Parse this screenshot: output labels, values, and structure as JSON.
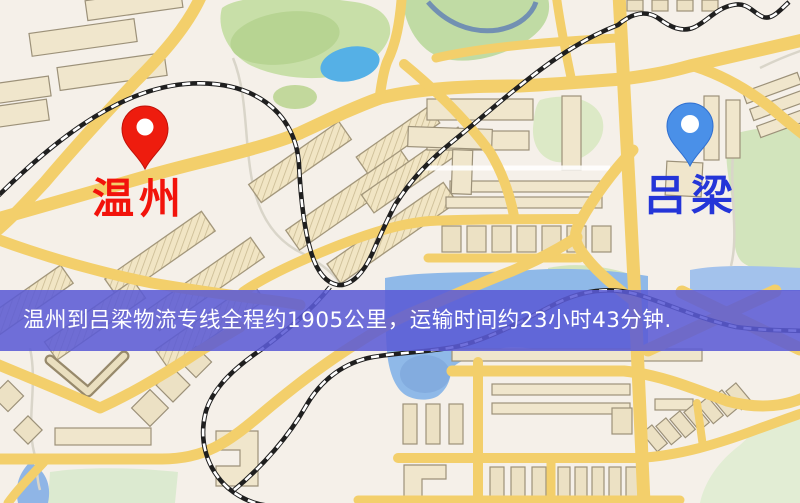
{
  "banner": {
    "text": "温州到吕梁物流专线全程约1905公里，运输时间约23小时43分钟.",
    "background": "#5b5bd6",
    "text_color": "#ffffff"
  },
  "markers": {
    "origin": {
      "label": "温州",
      "pin": "red-location-pin-icon",
      "pin_color": "#ee1c0e",
      "label_color": "#f2130b"
    },
    "destination": {
      "label": "吕梁",
      "pin": "blue-location-pin-icon",
      "pin_color": "#4a90e8",
      "label_color": "#2435d8"
    }
  },
  "route": {
    "from": "温州",
    "to": "吕梁",
    "distance_km": "1905",
    "duration": "23小时43分钟"
  },
  "map_colors": {
    "background": "#f5f0e9",
    "road_yellow": "#f3cf6b",
    "water_blue": "#8fb9e8",
    "lake_blue": "#55b0e6",
    "park_green": "#c8dfa8",
    "building_fill": "#f0e6cc",
    "building_outline": "#9c9179",
    "railway_black": "#1f1f1f"
  }
}
